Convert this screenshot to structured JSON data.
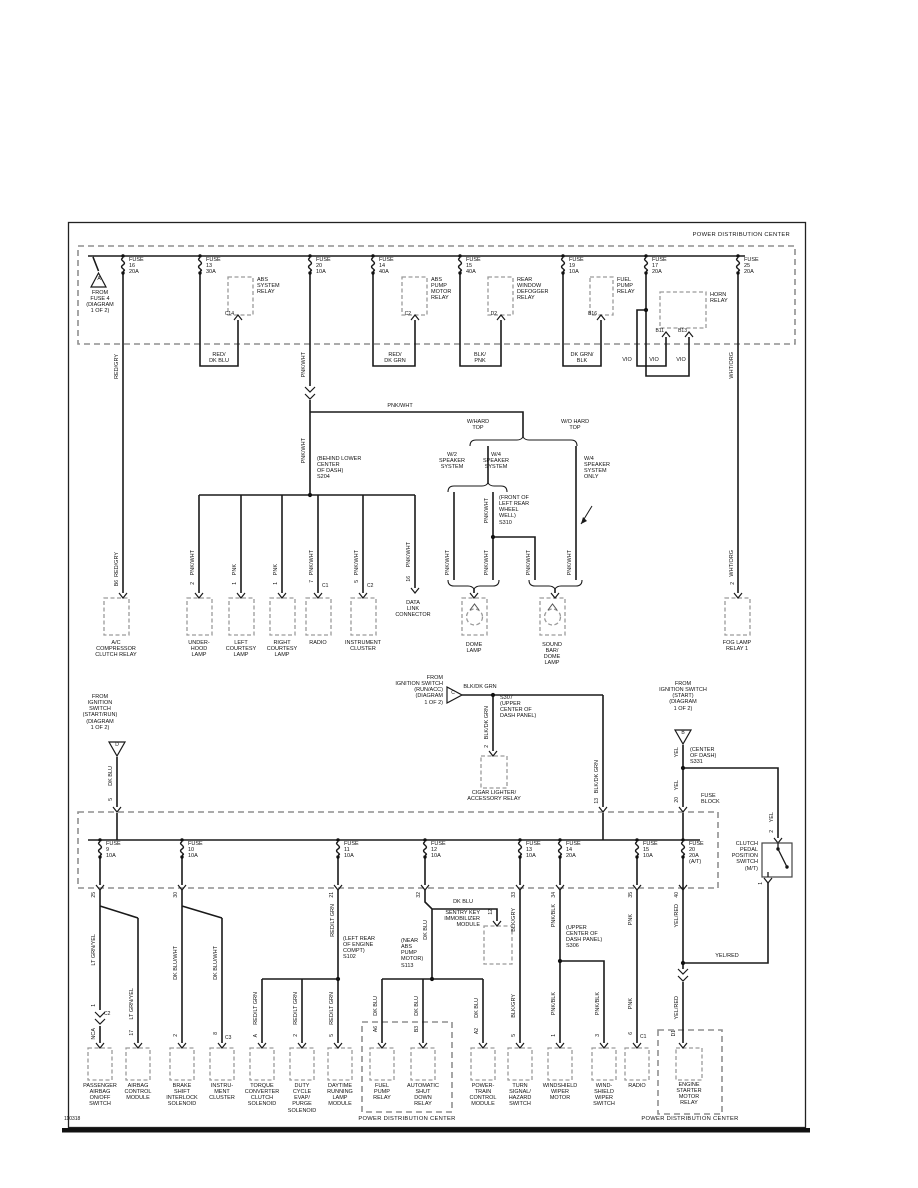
{
  "frame": {
    "footer_id": "110318"
  },
  "wire_colors": {
    "red_gry": "RED/GRY",
    "red_dk_blu": "RED/\nDK BLU",
    "pnk_wht": "PNK/WHT",
    "red_dk_grn": "RED/\nDK GRN",
    "blk_pnk": "BLK/\nPNK",
    "dk_grn_blk": "DK GRN/\nBLK",
    "vio": "VIO",
    "wht_org": "WHT/ORG",
    "pnk": "PNK",
    "blk_dk_grn": "BLK/DK GRN",
    "dk_blu": "DK BLU",
    "yel": "YEL",
    "yel_red": "YEL/RED",
    "lt_grn_yel": "LT GRN/YEL",
    "nca": "NCA",
    "dk_blu_wht": "DK BLU/WHT",
    "red_lt_grn": "RED/LT GRN",
    "blk_gry": "BLK/GRY",
    "pnk_blk": "PNK/BLK"
  },
  "pdc_top": {
    "box_label": "POWER DISTRIBUTION CENTER",
    "source_a": {
      "letter": "A",
      "label": "FROM\nFUSE 4\n(DIAGRAM\n1 OF 2)"
    },
    "fuses": [
      {
        "label": "FUSE\n16\n20A"
      },
      {
        "label": "FUSE\n13\n30A"
      },
      {
        "label": "FUSE\n20\n10A"
      },
      {
        "label": "FUSE\n14\n40A"
      },
      {
        "label": "FUSE\n15\n40A"
      },
      {
        "label": "FUSE\n19\n10A"
      },
      {
        "label": "FUSE\n17\n20A"
      },
      {
        "label": "FUSE\n25\n20A"
      }
    ],
    "relays": [
      {
        "label": "ABS\nSYSTEM\nRELAY",
        "pin": "C14"
      },
      {
        "label": "ABS\nPUMP\nMOTOR\nRELAY",
        "pin": "C2"
      },
      {
        "label": "REAR\nWINDOW\nDEFOGGER\nRELAY",
        "pin": "D2"
      },
      {
        "label": "FUEL\nPUMP\nRELAY",
        "pin": "B16"
      },
      {
        "label": "HORN\nRELAY",
        "pin_left": "B11",
        "pin_right": "B13"
      }
    ]
  },
  "splices": {
    "s204": "(BEHIND LOWER\nCENTER\nOF DASH)\nS204",
    "s310": "(FRONT OF\nLEFT REAR\nWHEEL\nWELL)\nS310",
    "s307": "S307\n(UPPER\nCENTER OF\nDASH PANEL)",
    "s331": "(CENTER\nOF DASH)\nS331",
    "s102": "(LEFT REAR\nOF ENGINE\nCOMPT)\nS102",
    "s113": "(NEAR\nABS\nPUMP\nMOTOR)\nS113",
    "s306": "(UPPER\nCENTER OF\nDASH PANEL)\nS306"
  },
  "options": {
    "w_hard_top": "W/HARD\nTOP",
    "wo_hard_top": "W/O HARD\nTOP",
    "w2_speaker": "W/2\nSPEAKER\nSYSTEM",
    "w4_speaker": "W/4\nSPEAKER\nSYSTEM",
    "w4_speaker_only": "W/4\nSPEAKER\nSYSTEM\nONLY"
  },
  "sources": {
    "b": {
      "letter": "B",
      "label": "FROM\nIGNITION SWITCH\n(START)\n(DIAGRAM\n1 OF 2)"
    },
    "c": {
      "letter": "C",
      "label": "FROM\nIGNITION SWITCH\n(RUN/ACC)\n(DIAGRAM\n1 OF 2)"
    },
    "d": {
      "letter": "D",
      "label": "FROM\nIGNITION\nSWITCH\n(START/RUN)\n(DIAGRAM\n1 OF 2)"
    }
  },
  "fuse_block": {
    "label": "FUSE\nBLOCK",
    "entry_pins": {
      "d_pin": "5",
      "c_pin": "13",
      "b_pin": "20"
    },
    "fuses": [
      {
        "label": "FUSE\n9\n10A",
        "pin": "25"
      },
      {
        "label": "FUSE\n10\n10A",
        "pin": "30"
      },
      {
        "label": "FUSE\n11\n10A",
        "pin": "21"
      },
      {
        "label": "FUSE\n12\n10A",
        "pin": "32"
      },
      {
        "label": "FUSE\n13\n10A",
        "pin": "33"
      },
      {
        "label": "FUSE\n14\n20A",
        "pin": "34"
      },
      {
        "label": "FUSE\n15\n10A",
        "pin": "35"
      },
      {
        "label": "FUSE\n20\n20A\n(A/T)",
        "pin": "40"
      }
    ]
  },
  "clutch_switch": {
    "label": "CLUTCH\nPEDAL\nPOSITION\nSWITCH\n(M/T)",
    "pin_in": "2",
    "pin_out": "1"
  },
  "sentry_module": {
    "label": "SENTRY KEY\nIMMOBILIZER\nMODULE",
    "pin": "12"
  },
  "cigar_relay": {
    "label": "CIGAR LIGHTER/\nACCESSORY RELAY",
    "pin": "2"
  },
  "data_link": {
    "label": "DATA\nLINK\nCONNECTOR",
    "pin": "16"
  },
  "components_row1": [
    {
      "label": "A/C\nCOMPRESSOR\nCLUTCH RELAY",
      "pin": "B6"
    },
    {
      "label": "UNDER-\nHOOD\nLAMP",
      "pin": "2"
    },
    {
      "label": "LEFT\nCOURTESY\nLAMP",
      "pin": "1"
    },
    {
      "label": "RIGHT\nCOURTESY\nLAMP",
      "pin": "1"
    },
    {
      "label": "RADIO",
      "pin": "7",
      "conn": "C1"
    },
    {
      "label": "INSTRUMENT\nCLUSTER",
      "pin": "5",
      "conn": "C2"
    },
    {
      "label": "DOME\nLAMP"
    },
    {
      "label": "SOUND\nBAR/\nDOME\nLAMP"
    },
    {
      "label": "FOG LAMP\nRELAY 1",
      "pin": "2"
    }
  ],
  "components_row2": [
    {
      "label": "PASSENGER\nAIRBAG\nON/OFF\nSWITCH",
      "pin": "1",
      "conn": "C2"
    },
    {
      "label": "AIRBAG\nCONTROL\nMODULE",
      "pin": "17"
    },
    {
      "label": "BRAKE\nSHIFT\nINTERLOCK\nSOLENOID",
      "pin": "2"
    },
    {
      "label": "INSTRU-\nMENT\nCLUSTER",
      "pin": "8",
      "conn": "C3"
    },
    {
      "label": "TORQUE\nCONVERTER\nCLUTCH\nSOLENOID",
      "pin": "A"
    },
    {
      "label": "DUTY\nCYCLE\nEVAP/\nPURGE\nSOLENOID",
      "pin": "2"
    },
    {
      "label": "DAYTIME\nRUNNING\nLAMP\nMODULE",
      "pin": "5"
    },
    {
      "label": "FUEL\nPUMP\nRELAY",
      "pin": "A6"
    },
    {
      "label": "AUTOMATIC\nSHUT\nDOWN\nRELAY",
      "pin": "B3"
    },
    {
      "label": "POWER-\nTRAIN\nCONTROL\nMODULE",
      "pin": "A2"
    },
    {
      "label": "TURN\nSIGNAL/\nHAZARD\nSWITCH",
      "pin": "5"
    },
    {
      "label": "WINDSHIELD\nWIPER\nMOTOR",
      "pin": "1"
    },
    {
      "label": "WIND-\nSHIELD\nWIPER\nSWITCH",
      "pin": "3"
    },
    {
      "label": "RADIO",
      "pin": "6",
      "conn": "C1"
    },
    {
      "label": "ENGINE\nSTARTER\nMOTOR\nRELAY",
      "pin": "D1"
    }
  ],
  "pdc_bottom_mid": {
    "box_label": "POWER DISTRIBUTION CENTER"
  },
  "pdc_bottom_right": {
    "box_label": "POWER DISTRIBUTION CENTER"
  }
}
